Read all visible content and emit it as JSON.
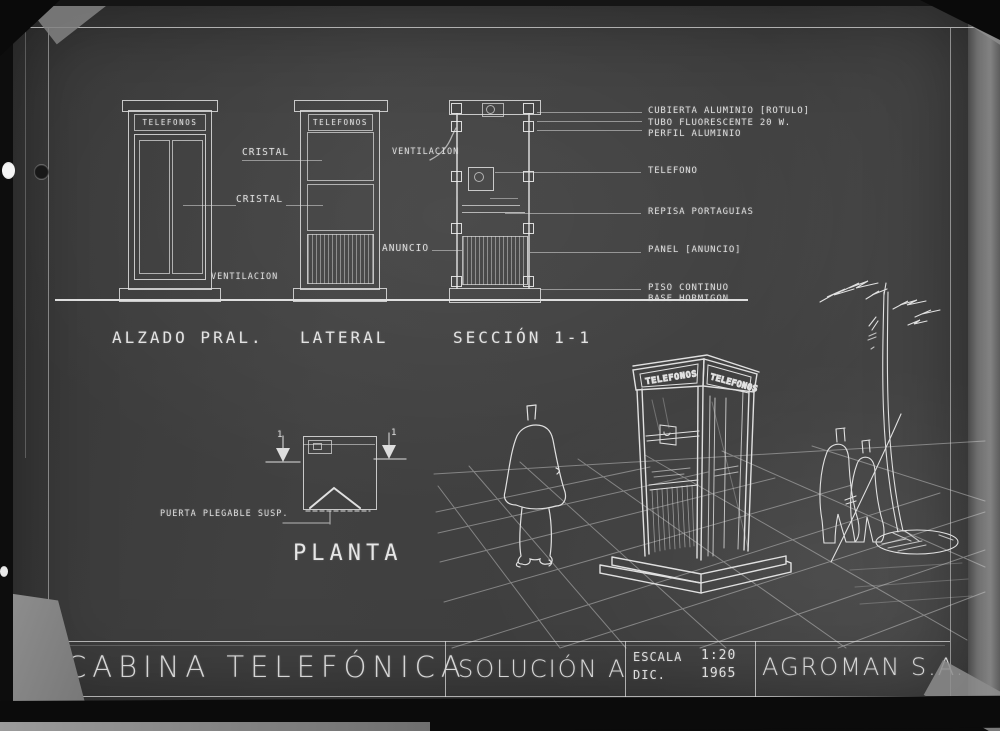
{
  "titleblock": {
    "project": "CABINA TELEFÓNICA",
    "solution": "SOLUCIÓN A",
    "scale_label": "ESCALA",
    "scale_value": "1:20",
    "date_month": "DIC.",
    "date_year": "1965",
    "company": "AGROMAN S.A."
  },
  "views": {
    "alzado": {
      "title": "ALZADO PRAL."
    },
    "lateral": {
      "title": "LATERAL"
    },
    "seccion": {
      "title": "SECCIÓN 1-1"
    },
    "planta": {
      "title": "PLANTA"
    }
  },
  "signs": {
    "booth": "TELEFONOS"
  },
  "labels": {
    "cristal": "CRISTAL",
    "ventilacion": "VENTILACION",
    "anuncio": "ANUNCIO",
    "puerta_plegable": "PUERTA PLEGABLE SUSP.",
    "section_marker": "1"
  },
  "callouts": [
    "CUBIERTA ALUMINIO [ROTULO]",
    "TUBO FLUORESCENTE 20 W.",
    "PERFIL ALUMINIO",
    "TELEFONO",
    "REPISA PORTAGUIAS",
    "PANEL [ANUNCIO]",
    "PISO CONTINUO",
    "BASE HORMIGON"
  ],
  "colors": {
    "sheet": "#3f3f3f",
    "line": "#d9d9d9",
    "bright": "#efefef",
    "paper_edge": "#7c7c7c",
    "border": "#0b0b0b"
  }
}
